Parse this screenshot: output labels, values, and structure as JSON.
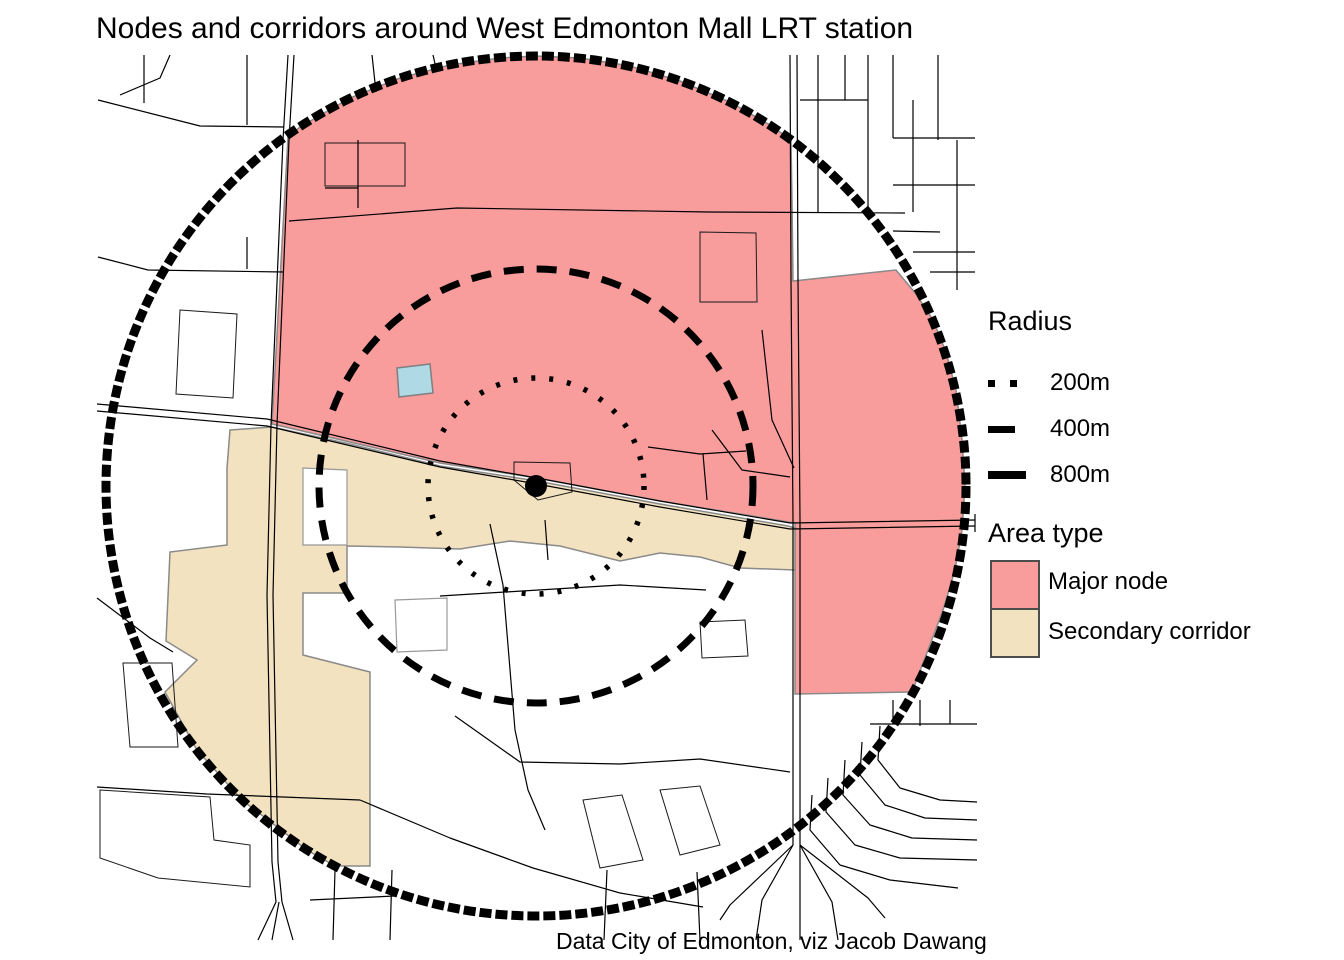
{
  "title": "Nodes and corridors around West Edmonton Mall LRT station",
  "caption": "Data City of Edmonton, viz Jacob Dawang",
  "colors": {
    "major_node": "#F89C9C",
    "secondary_corridor": "#F3E2BF",
    "water": "#B0D9E6",
    "area_border": "#8A8A8A",
    "hole_border": "#999999",
    "road": "#000000",
    "ring": "#000000",
    "swatch_border": "#4d4d4d"
  },
  "legend": {
    "radius": {
      "title": "Radius",
      "items": [
        {
          "label": "200m",
          "style": "dotted"
        },
        {
          "label": "400m",
          "style": "dashed"
        },
        {
          "label": "800m",
          "style": "solid"
        }
      ]
    },
    "area_type": {
      "title": "Area type",
      "items": [
        {
          "label": "Major node",
          "color_key": "major_node"
        },
        {
          "label": "Secondary corridor",
          "color_key": "secondary_corridor"
        }
      ]
    }
  },
  "map": {
    "center": {
      "x": 536,
      "y": 486
    },
    "station": {
      "radius": 11
    },
    "rings": [
      {
        "label": "200m",
        "radius": 108,
        "stroke_width": 5.5,
        "dash": "4 14",
        "linecap": "butt"
      },
      {
        "label": "400m",
        "radius": 217,
        "stroke_width": 7,
        "dash": "20 13",
        "linecap": "butt"
      },
      {
        "label": "800m",
        "radius": 430,
        "stroke_width": 9,
        "dash": "12 4",
        "linecap": "butt"
      }
    ],
    "areas": {
      "major_node": [
        [
          [
            288,
            137
          ],
          [
            300,
            127
          ],
          [
            350,
            98
          ],
          [
            400,
            78
          ],
          [
            450,
            65
          ],
          [
            500,
            58
          ],
          [
            536,
            56
          ],
          [
            580,
            58
          ],
          [
            630,
            66
          ],
          [
            680,
            81
          ],
          [
            730,
            102
          ],
          [
            770,
            125
          ],
          [
            791,
            140
          ],
          [
            792,
            200
          ],
          [
            793,
            281
          ],
          [
            896,
            270
          ],
          [
            916,
            294
          ],
          [
            933,
            320
          ],
          [
            946,
            352
          ],
          [
            956,
            390
          ],
          [
            962,
            440
          ],
          [
            965,
            486
          ],
          [
            962,
            530
          ],
          [
            955,
            570
          ],
          [
            943,
            610
          ],
          [
            928,
            650
          ],
          [
            912,
            692
          ],
          [
            795,
            694
          ],
          [
            795,
            523
          ],
          [
            660,
            501
          ],
          [
            537,
            478
          ],
          [
            440,
            463
          ],
          [
            350,
            442
          ],
          [
            272,
            424
          ]
        ]
      ],
      "secondary_corridor": [
        [
          [
            230,
            430
          ],
          [
            272,
            427
          ],
          [
            350,
            444
          ],
          [
            440,
            466
          ],
          [
            537,
            481
          ],
          [
            660,
            504
          ],
          [
            788,
            526
          ],
          [
            795,
            528
          ],
          [
            795,
            570
          ],
          [
            740,
            568
          ],
          [
            700,
            557
          ],
          [
            660,
            553
          ],
          [
            620,
            561
          ],
          [
            560,
            546
          ],
          [
            510,
            541
          ],
          [
            460,
            549
          ],
          [
            400,
            547
          ],
          [
            347,
            546
          ],
          [
            347,
            593
          ],
          [
            303,
            593
          ],
          [
            303,
            655
          ],
          [
            370,
            672
          ],
          [
            370,
            866
          ],
          [
            335,
            866
          ],
          [
            307,
            850
          ],
          [
            242,
            800
          ],
          [
            197,
            750
          ],
          [
            165,
            692
          ],
          [
            197,
            660
          ],
          [
            166,
            641
          ],
          [
            170,
            552
          ],
          [
            227,
            545
          ],
          [
            227,
            468
          ]
        ]
      ],
      "holes": [
        [
          [
            303,
            468
          ],
          [
            347,
            470
          ],
          [
            347,
            545
          ],
          [
            303,
            545
          ]
        ],
        [
          [
            395,
            600
          ],
          [
            447,
            598
          ],
          [
            447,
            650
          ],
          [
            397,
            652
          ]
        ]
      ]
    },
    "pond": [
      [
        397,
        368
      ],
      [
        430,
        364
      ],
      [
        433,
        393
      ],
      [
        399,
        397
      ]
    ],
    "parcels": [
      [
        [
          180,
          310
        ],
        [
          237,
          314
        ],
        [
          233,
          398
        ],
        [
          176,
          394
        ]
      ],
      [
        [
          325,
          143
        ],
        [
          405,
          143
        ],
        [
          405,
          186
        ],
        [
          325,
          186
        ]
      ],
      [
        [
          700,
          232
        ],
        [
          756,
          233
        ],
        [
          757,
          302
        ],
        [
          700,
          302
        ]
      ],
      [
        [
          514,
          462
        ],
        [
          570,
          463
        ],
        [
          572,
          492
        ],
        [
          538,
          500
        ],
        [
          514,
          480
        ]
      ],
      [
        [
          123,
          663
        ],
        [
          172,
          663
        ],
        [
          178,
          747
        ],
        [
          130,
          747
        ]
      ],
      [
        [
          100,
          790
        ],
        [
          210,
          797
        ],
        [
          214,
          840
        ],
        [
          250,
          845
        ],
        [
          250,
          887
        ],
        [
          158,
          878
        ],
        [
          100,
          858
        ]
      ],
      [
        [
          700,
          622
        ],
        [
          745,
          620
        ],
        [
          748,
          656
        ],
        [
          702,
          658
        ]
      ],
      [
        [
          583,
          800
        ],
        [
          622,
          795
        ],
        [
          643,
          860
        ],
        [
          600,
          868
        ]
      ],
      [
        [
          660,
          790
        ],
        [
          700,
          786
        ],
        [
          720,
          845
        ],
        [
          680,
          855
        ]
      ]
    ],
    "roads": [
      [
        [
          288,
          55
        ],
        [
          283,
          140
        ],
        [
          271,
          425
        ]
      ],
      [
        [
          294,
          55
        ],
        [
          289,
          140
        ],
        [
          277,
          425
        ]
      ],
      [
        [
          271,
          425
        ],
        [
          267,
          595
        ],
        [
          272,
          862
        ],
        [
          276,
          902
        ],
        [
          258,
          940
        ]
      ],
      [
        [
          277,
          425
        ],
        [
          273,
          595
        ],
        [
          278,
          862
        ],
        [
          282,
          902
        ],
        [
          293,
          940
        ]
      ],
      [
        [
          279,
          902
        ],
        [
          272,
          940
        ]
      ],
      [
        [
          790,
          55
        ],
        [
          791,
          280
        ],
        [
          793,
          520
        ],
        [
          793,
          845
        ]
      ],
      [
        [
          797,
          55
        ],
        [
          798,
          280
        ],
        [
          800,
          520
        ],
        [
          800,
          845
        ]
      ],
      [
        [
          793,
          845
        ],
        [
          762,
          900
        ],
        [
          756,
          940
        ]
      ],
      [
        [
          800,
          845
        ],
        [
          800,
          940
        ]
      ],
      [
        [
          800,
          845
        ],
        [
          832,
          902
        ],
        [
          838,
          940
        ]
      ],
      [
        [
          800,
          845
        ],
        [
          868,
          898
        ],
        [
          885,
          918
        ]
      ],
      [
        [
          793,
          845
        ],
        [
          730,
          905
        ],
        [
          720,
          920
        ]
      ],
      [
        [
          97,
          404
        ],
        [
          267,
          419
        ],
        [
          440,
          461
        ],
        [
          537,
          478
        ],
        [
          660,
          501
        ],
        [
          790,
          523
        ],
        [
          975,
          520
        ]
      ],
      [
        [
          97,
          411
        ],
        [
          267,
          426
        ],
        [
          440,
          467
        ],
        [
          537,
          484
        ],
        [
          660,
          507
        ],
        [
          790,
          529
        ],
        [
          975,
          526
        ]
      ],
      [
        [
          975,
          514
        ],
        [
          975,
          532
        ]
      ],
      [
        [
          289,
          221
        ],
        [
          457,
          208
        ],
        [
          708,
          212
        ],
        [
          905,
          213
        ]
      ],
      [
        [
          98,
          100
        ],
        [
          200,
          126
        ],
        [
          284,
          127
        ]
      ],
      [
        [
          98,
          257
        ],
        [
          148,
          270
        ],
        [
          284,
          272
        ]
      ],
      [
        [
          144,
          55
        ],
        [
          144,
          103
        ]
      ],
      [
        [
          247,
          55
        ],
        [
          247,
          125
        ]
      ],
      [
        [
          247,
          237
        ],
        [
          247,
          269
        ]
      ],
      [
        [
          170,
          55
        ],
        [
          160,
          78
        ],
        [
          120,
          95
        ]
      ],
      [
        [
          372,
          55
        ],
        [
          376,
          92
        ]
      ],
      [
        [
          358,
          140
        ],
        [
          358,
          208
        ]
      ],
      [
        [
          325,
          188
        ],
        [
          358,
          188
        ]
      ],
      [
        [
          762,
          330
        ],
        [
          772,
          420
        ],
        [
          794,
          468
        ]
      ],
      [
        [
          712,
          430
        ],
        [
          742,
          470
        ],
        [
          790,
          477
        ]
      ],
      [
        [
          648,
          447
        ],
        [
          700,
          454
        ],
        [
          746,
          451
        ]
      ],
      [
        [
          703,
          454
        ],
        [
          707,
          500
        ]
      ],
      [
        [
          490,
          524
        ],
        [
          503,
          585
        ],
        [
          515,
          730
        ],
        [
          528,
          790
        ],
        [
          545,
          830
        ]
      ],
      [
        [
          440,
          596
        ],
        [
          620,
          585
        ],
        [
          706,
          590
        ]
      ],
      [
        [
          545,
          520
        ],
        [
          548,
          560
        ]
      ],
      [
        [
          455,
          716
        ],
        [
          520,
          762
        ],
        [
          620,
          764
        ],
        [
          700,
          759
        ],
        [
          790,
          772
        ]
      ],
      [
        [
          310,
          900
        ],
        [
          395,
          896
        ]
      ],
      [
        [
          335,
          870
        ],
        [
          333,
          940
        ]
      ],
      [
        [
          392,
          870
        ],
        [
          390,
          940
        ]
      ],
      [
        [
          607,
          870
        ],
        [
          604,
          940
        ]
      ],
      [
        [
          697,
          872
        ],
        [
          700,
          940
        ]
      ],
      [
        [
          360,
          800
        ],
        [
          450,
          838
        ],
        [
          533,
          868
        ],
        [
          620,
          893
        ],
        [
          703,
          907
        ]
      ],
      [
        [
          97,
          598
        ],
        [
          150,
          638
        ],
        [
          173,
          652
        ]
      ],
      [
        [
          97,
          787
        ],
        [
          207,
          794
        ],
        [
          360,
          800
        ]
      ],
      [
        [
          818,
          55
        ],
        [
          818,
          212
        ]
      ],
      [
        [
          845,
          55
        ],
        [
          845,
          100
        ]
      ],
      [
        [
          868,
          55
        ],
        [
          868,
          212
        ]
      ],
      [
        [
          893,
          55
        ],
        [
          893,
          138
        ]
      ],
      [
        [
          913,
          100
        ],
        [
          913,
          212
        ]
      ],
      [
        [
          938,
          55
        ],
        [
          938,
          140
        ]
      ],
      [
        [
          957,
          140
        ],
        [
          957,
          290
        ]
      ],
      [
        [
          800,
          100
        ],
        [
          868,
          100
        ]
      ],
      [
        [
          893,
          138
        ],
        [
          975,
          138
        ]
      ],
      [
        [
          893,
          185
        ],
        [
          975,
          185
        ]
      ],
      [
        [
          893,
          231
        ],
        [
          940,
          232
        ]
      ],
      [
        [
          913,
          252
        ],
        [
          975,
          252
        ]
      ],
      [
        [
          930,
          272
        ],
        [
          975,
          272
        ]
      ],
      [
        [
          880,
          726
        ],
        [
          878,
          760
        ],
        [
          900,
          788
        ],
        [
          940,
          800
        ],
        [
          977,
          802
        ]
      ],
      [
        [
          862,
          742
        ],
        [
          860,
          775
        ],
        [
          885,
          805
        ],
        [
          925,
          818
        ],
        [
          977,
          820
        ]
      ],
      [
        [
          845,
          760
        ],
        [
          843,
          795
        ],
        [
          870,
          825
        ],
        [
          912,
          838
        ],
        [
          977,
          840
        ]
      ],
      [
        [
          828,
          778
        ],
        [
          826,
          812
        ],
        [
          855,
          845
        ],
        [
          900,
          858
        ],
        [
          977,
          860
        ]
      ],
      [
        [
          812,
          795
        ],
        [
          810,
          830
        ],
        [
          840,
          865
        ],
        [
          890,
          880
        ],
        [
          958,
          888
        ]
      ],
      [
        [
          870,
          724
        ],
        [
          977,
          724
        ]
      ],
      [
        [
          893,
          700
        ],
        [
          893,
          724
        ]
      ],
      [
        [
          920,
          700
        ],
        [
          920,
          726
        ]
      ],
      [
        [
          950,
          700
        ],
        [
          950,
          724
        ]
      ],
      [
        [
          433,
          55
        ],
        [
          436,
          68
        ]
      ]
    ]
  }
}
